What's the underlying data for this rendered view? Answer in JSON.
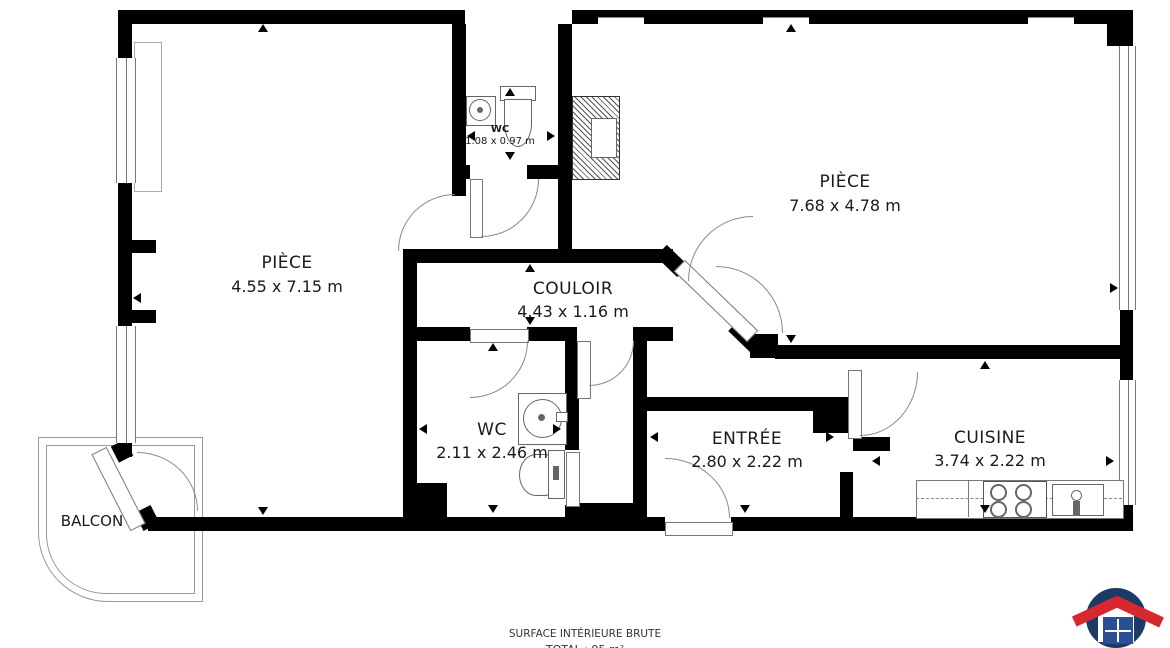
{
  "plan": {
    "rooms": [
      {
        "id": "piece-left",
        "name": "PIÈCE",
        "dims": "4.55 x 7.15 m"
      },
      {
        "id": "piece-right",
        "name": "PIÈCE",
        "dims": "7.68 x 4.78 m"
      },
      {
        "id": "wc-top",
        "name": "WC",
        "dims": "1.08 x 0.97 m"
      },
      {
        "id": "couloir",
        "name": "COULOIR",
        "dims": "4.43 x 1.16 m"
      },
      {
        "id": "wc",
        "name": "WC",
        "dims": "2.11 x 2.46 m"
      },
      {
        "id": "entree",
        "name": "ENTRÉE",
        "dims": "2.80 x 2.22 m"
      },
      {
        "id": "cuisine",
        "name": "CUISINE",
        "dims": "3.74 x 2.22 m"
      },
      {
        "id": "balcon",
        "name": "BALCON",
        "dims": ""
      }
    ],
    "footer": {
      "line1": "SURFACE INTÉRIEURE BRUTE",
      "line2": "TOTAL : 95 m²"
    },
    "colors": {
      "wall": "#000000",
      "thin_line": "#8a8a8a",
      "logo_blue": "#1c3a66",
      "logo_red": "#d6282e",
      "logo_window_blue": "#2b4f92"
    }
  }
}
